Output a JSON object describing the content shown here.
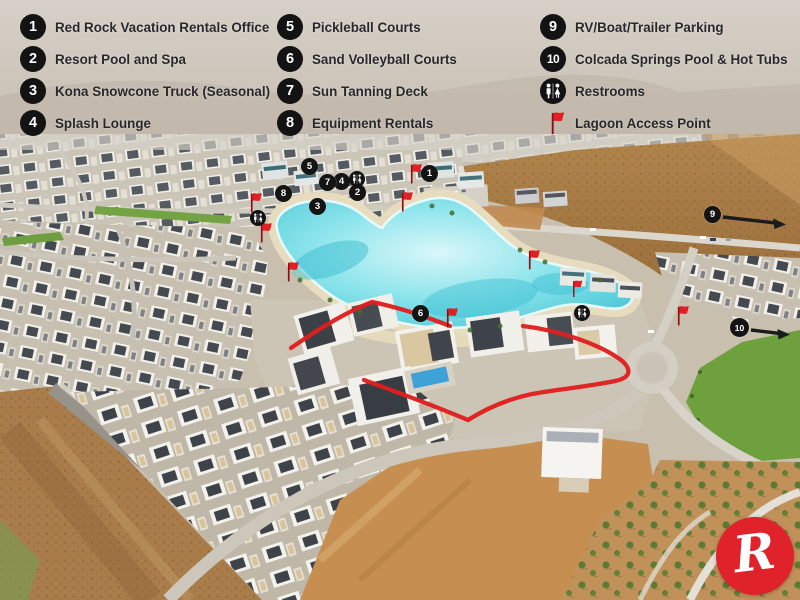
{
  "legend": {
    "columns": [
      {
        "items": [
          {
            "number": "1",
            "label": "Red Rock Vacation Rentals Office"
          },
          {
            "number": "2",
            "label": "Resort Pool and Spa"
          },
          {
            "number": "3",
            "label": "Kona Snowcone Truck (Seasonal)"
          },
          {
            "number": "4",
            "label": "Splash Lounge"
          }
        ]
      },
      {
        "items": [
          {
            "number": "5",
            "label": "Pickleball Courts"
          },
          {
            "number": "6",
            "label": "Sand Volleyball Courts"
          },
          {
            "number": "7",
            "label": "Sun Tanning Deck"
          },
          {
            "number": "8",
            "label": "Equipment Rentals"
          }
        ]
      },
      {
        "items": [
          {
            "number": "9",
            "label": "RV/Boat/Trailer Parking"
          },
          {
            "number": "10",
            "label": "Colcada Springs Pool & Hot Tubs"
          },
          {
            "icon": "restrooms-icon",
            "label": "Restrooms"
          },
          {
            "icon": "red-flag-icon",
            "label": "Lagoon Access Point"
          }
        ]
      }
    ]
  },
  "map": {
    "markers": [
      {
        "number": "1"
      },
      {
        "number": "2"
      },
      {
        "number": "3"
      },
      {
        "number": "4"
      },
      {
        "number": "5"
      },
      {
        "number": "6"
      },
      {
        "number": "7"
      },
      {
        "number": "8"
      },
      {
        "number": "9"
      },
      {
        "number": "10"
      }
    ],
    "lagoon_flag_count": 9,
    "restroom_icon_count": 3
  },
  "logo": {
    "letter": "R"
  },
  "colors": {
    "accent_red": "#e0222b",
    "marker_black": "#141414",
    "lagoon_turquoise": "#5fd2de",
    "desert_tan": "#a97c4a",
    "grass_green": "#6fa03e"
  }
}
